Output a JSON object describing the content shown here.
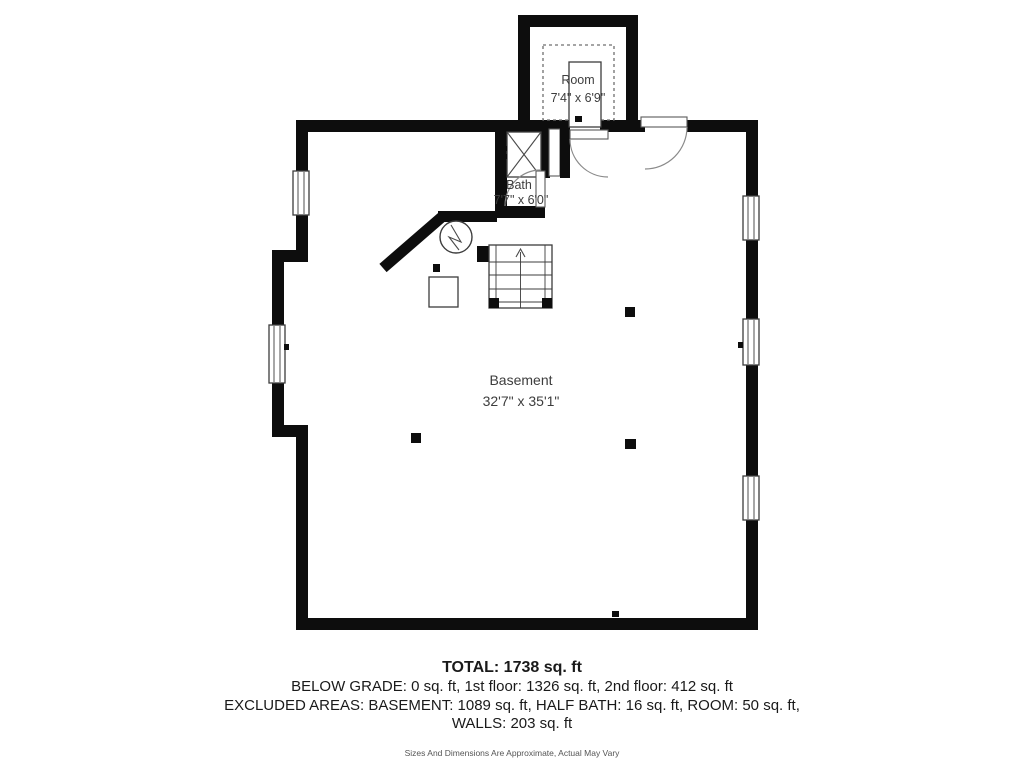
{
  "plan": {
    "room": {
      "name": "Room",
      "dims": "7'4\" x 6'9\""
    },
    "bath": {
      "name": "Bath",
      "dims": "7'7\" x 6'0\""
    },
    "basement": {
      "name": "Basement",
      "dims": "32'7\" x 35'1\""
    }
  },
  "footer": {
    "total": "TOTAL: 1738 sq. ft",
    "grade_line": "BELOW GRADE: 0 sq. ft, 1st floor: 1326 sq. ft, 2nd floor: 412 sq. ft",
    "excluded_line": "EXCLUDED AREAS: BASEMENT: 1089 sq. ft, HALF BATH: 16 sq. ft, ROOM: 50 sq. ft,",
    "walls_line": "WALLS: 203 sq. ft",
    "disclaimer": "Sizes And Dimensions Are Approximate, Actual May Vary"
  },
  "colors": {
    "wall": "#0d0d0d",
    "line": "#3c3c3c",
    "door_arc": "#8a8a8a",
    "label_text": "#3d3d3d"
  }
}
